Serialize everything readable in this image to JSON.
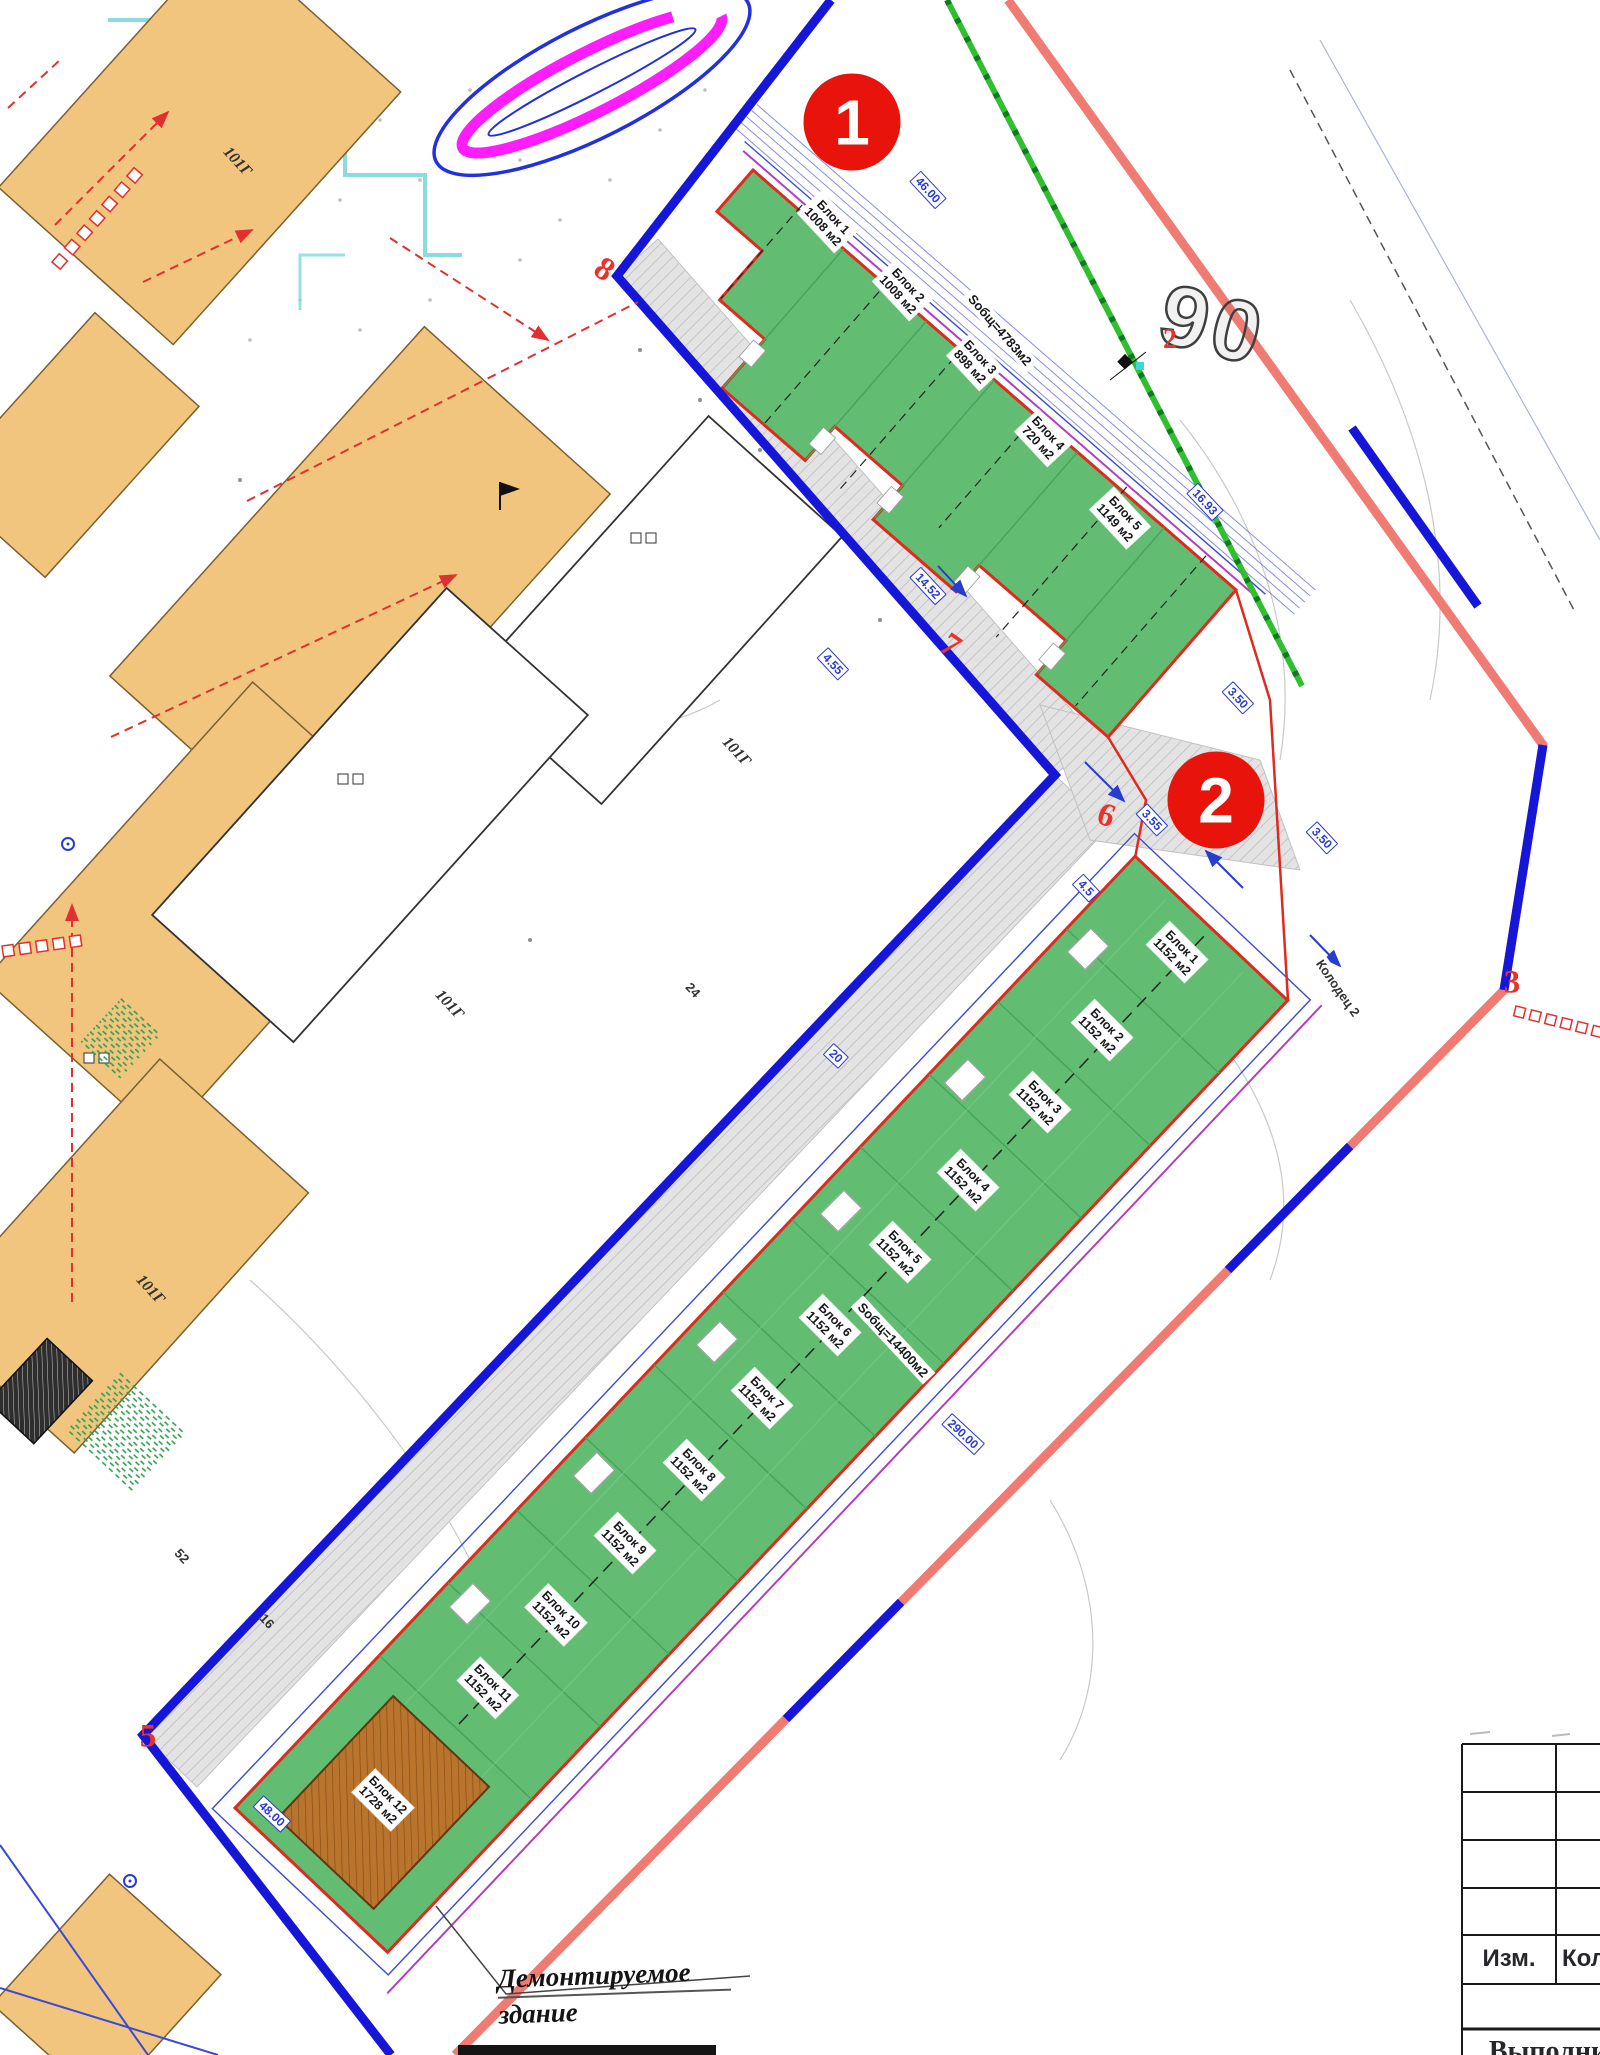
{
  "annotations": {
    "marker1": "1",
    "marker2": "2"
  },
  "area_number": "90",
  "upper_area": {
    "total_label": "Sобщ=4783м2",
    "blocks": [
      {
        "name": "Блок 1",
        "area": "1008 м2"
      },
      {
        "name": "Блок 2",
        "area": "1008 м2"
      },
      {
        "name": "Блок 3",
        "area": "898 м2"
      },
      {
        "name": "Блок 4",
        "area": "720 м2"
      },
      {
        "name": "Блок 5",
        "area": "1149 м2"
      }
    ]
  },
  "lower_area": {
    "total_label": "Sобщ=14400м2",
    "blocks": [
      {
        "name": "Блок 1",
        "area": "1152 м2"
      },
      {
        "name": "Блок 2",
        "area": "1152 м2"
      },
      {
        "name": "Блок 3",
        "area": "1152 м2"
      },
      {
        "name": "Блок 4",
        "area": "1152 м2"
      },
      {
        "name": "Блок 5",
        "area": "1152 м2"
      },
      {
        "name": "Блок 6",
        "area": "1152 м2"
      },
      {
        "name": "Блок 7",
        "area": "1152 м2"
      },
      {
        "name": "Блок 8",
        "area": "1152 м2"
      },
      {
        "name": "Блок 9",
        "area": "1152 м2"
      },
      {
        "name": "Блок 10",
        "area": "1152 м2"
      },
      {
        "name": "Блок 11",
        "area": "1152 м2"
      },
      {
        "name": "Блок 12",
        "area": "1728 м2"
      }
    ]
  },
  "vertices": [
    "8",
    "7",
    "6",
    "5",
    "3",
    "2"
  ],
  "dimensions": [
    "46.00",
    "16.93",
    "14.52",
    "3.50",
    "3.55",
    "4.5",
    "3.50",
    "4.55",
    "290.00",
    "48.00",
    "20"
  ],
  "site_labels": {
    "well": "Колодец 2",
    "building_code": "101Г",
    "misc": [
      "52",
      "16",
      "24"
    ]
  },
  "note": {
    "line1": "Демонтируемое",
    "line2": "здание"
  },
  "title_block": {
    "col_izm": "Изм.",
    "col_kol": "Кол",
    "bottom_text": "Выполни"
  },
  "colors": {
    "boundary_blue": "#1616d9",
    "boundary_red": "#ef7b72",
    "area_green": "#62bd72",
    "area_border_red": "#dd2b1f",
    "marker_red": "#e8140c",
    "building_orange": "#f2c57e",
    "utility_green": "#2fbf2f",
    "magenta": "#ff1cff",
    "cyan": "#7fd8da",
    "dim_blue": "#2a3bd0"
  }
}
